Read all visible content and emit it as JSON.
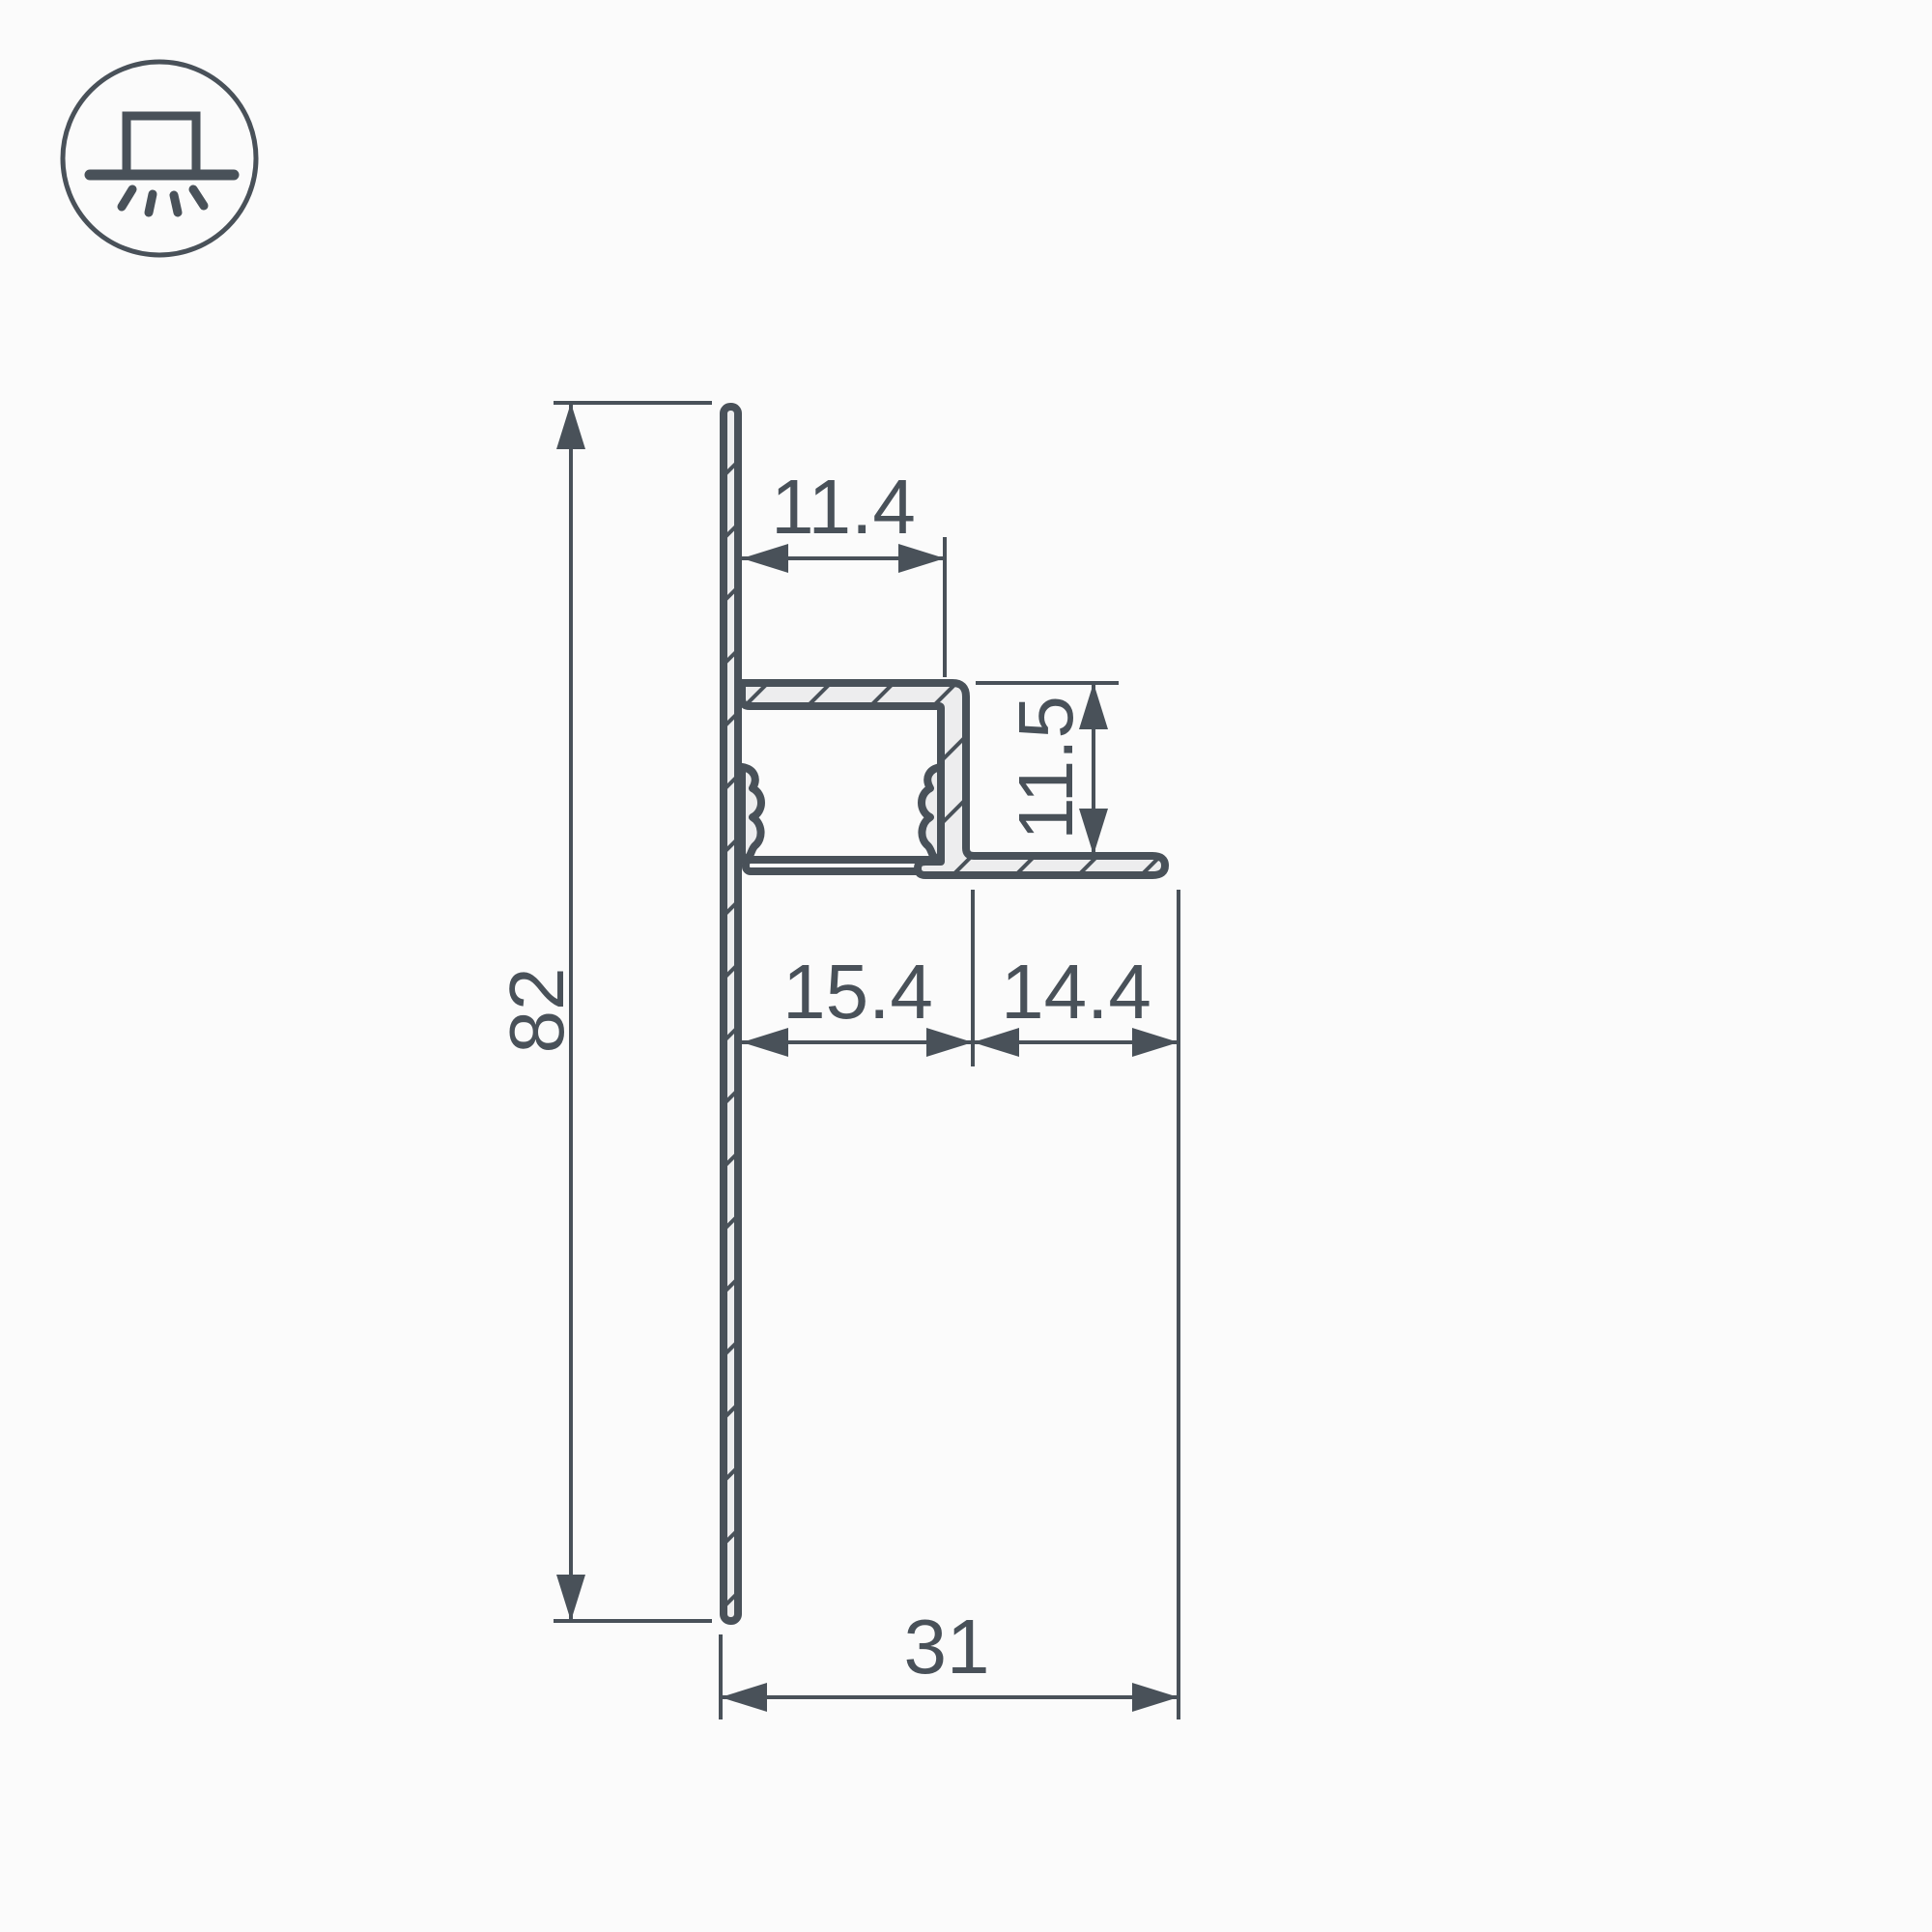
{
  "page": {
    "type": "technical-drawing",
    "background": "#fbfbfb"
  },
  "palette": {
    "line_color": "#495159",
    "metal_fill": "#ededee",
    "diffuser_fill": "#fdfdfd"
  },
  "icon": {
    "meaning": "surface-mounted-downlight",
    "shape": "lamp-box-on-line-with-rays-in-circle"
  },
  "dimensions": {
    "profile_height": "82",
    "channel_width": "11.4",
    "step_height": "11.5",
    "channel_outer_width": "15.4",
    "flange_width": "14.4",
    "total_depth": "31"
  }
}
